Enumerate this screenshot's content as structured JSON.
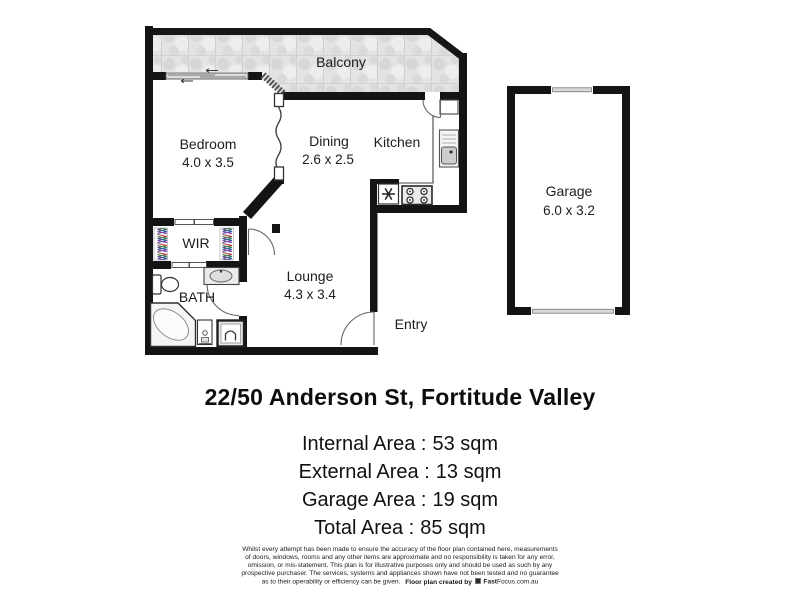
{
  "floor_plan": {
    "rooms": {
      "balcony": {
        "label": "Balcony"
      },
      "bedroom": {
        "label": "Bedroom",
        "dims": "4.0 x 3.5"
      },
      "dining": {
        "label": "Dining",
        "dims": "2.6 x 2.5"
      },
      "kitchen": {
        "label": "Kitchen"
      },
      "wir": {
        "label": "WIR"
      },
      "bath": {
        "label": "BATH"
      },
      "lounge": {
        "label": "Lounge",
        "dims": "4.3 x 3.4"
      },
      "entry": {
        "label": "Entry"
      },
      "garage": {
        "label": "Garage",
        "dims": "6.0 x 3.2"
      }
    },
    "colors": {
      "wall": "#141414",
      "balcony_fill": "#e2e2e2",
      "fixture_line": "#3c3c3c",
      "wardrobe_hatch": [
        "#b23a3a",
        "#2e8b57",
        "#3f51b5",
        "#8e44ad"
      ]
    }
  },
  "address": {
    "title": "22/50 Anderson St, Fortitude Valley"
  },
  "areas": [
    {
      "label": "Internal Area :",
      "value": "53 sqm"
    },
    {
      "label": "External Area :",
      "value": "13 sqm"
    },
    {
      "label": "Garage Area :",
      "value": "19 sqm"
    },
    {
      "label": "Total Area :",
      "value": "85 sqm"
    }
  ],
  "disclaimer": {
    "lines": [
      "Whilst every attempt has been made to ensure the accuracy of the floor plan contained here, measurements",
      "of doors, windows, rooms and any other items are approximate and no responsibility is taken for any error,",
      "omission, or mis-statement. This plan is for illustrative purposes only and should be used as such by any",
      "prospective purchaser. The services, systems and appliances shown have not been tested and no guarantee",
      "as to their operability or efficiency can be given."
    ],
    "credit": {
      "prefix": "Floor plan created by",
      "brand_bold": "Fast",
      "brand_rest": "Focus.com.au"
    }
  }
}
